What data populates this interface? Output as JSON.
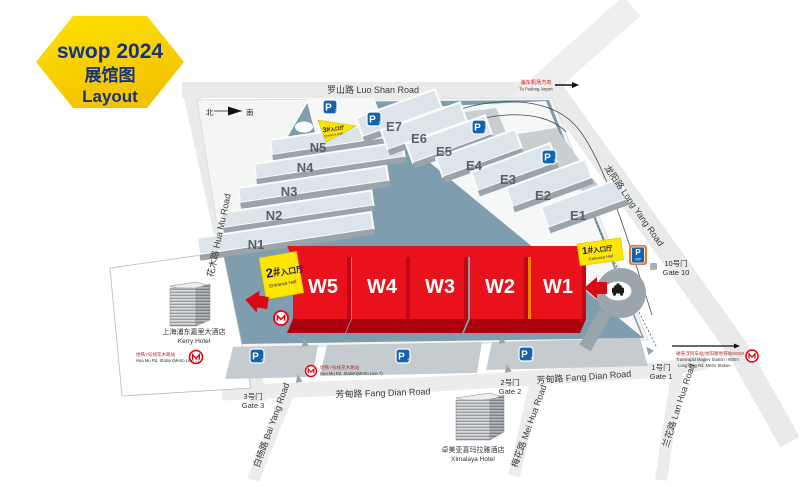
{
  "badge": {
    "title": "swop 2024",
    "subtitle_zh": "展馆图",
    "subtitle_en": "Layout"
  },
  "compass": {
    "north": "北",
    "south": "南"
  },
  "roads": {
    "luo_shan": "罗山路 Luo Shan Road",
    "long_yang": "龙阳路 Long Yang Road",
    "hua_mu": "花木路 Hua Mu Road",
    "fang_dian_west": "芳甸路 Fang Dian Road",
    "fang_dian_east": "芳甸路 Fang Dian Road",
    "bai_yang": "白杨路 Bai Yang Road",
    "mei_hua": "梅花路 Mei Hua Road",
    "lan_hua": "兰花路 Lan Hua Road"
  },
  "direction_sign": {
    "zh": "浦东机场方向",
    "en": "To Pudong Airport"
  },
  "halls": {
    "west": [
      "W5",
      "W4",
      "W3",
      "W2",
      "W1"
    ],
    "north": [
      "N5",
      "N4",
      "N3",
      "N2",
      "N1"
    ],
    "east": [
      "E7",
      "E6",
      "E5",
      "E4",
      "E3",
      "E2",
      "E1"
    ]
  },
  "entrance_halls": {
    "hall1": {
      "num": "1#",
      "zh": "入口厅",
      "en": "Entrance Hall"
    },
    "hall2": {
      "num": "2#",
      "zh": "入口厅",
      "en": "Entrance Hall"
    },
    "hall3": {
      "num": "3#",
      "zh": "入口厅",
      "en": "Entrance Hall"
    }
  },
  "gates": {
    "gate1": {
      "zh": "1号门",
      "en": "Gate 1"
    },
    "gate2": {
      "zh": "2号门",
      "en": "Gate 2"
    },
    "gate3": {
      "zh": "3号门",
      "en": "Gate 3"
    },
    "gate10": {
      "zh": "10号门",
      "en": "Gate 10"
    }
  },
  "parking_lots": [
    {
      "label": "P",
      "sub": "7"
    },
    {
      "label": "P",
      "sub": "1"
    },
    {
      "label": "P",
      "sub": "2"
    },
    {
      "label": "P",
      "sub": "3"
    },
    {
      "label": "P",
      "sub": "6"
    },
    {
      "label": "P",
      "sub": "5"
    },
    {
      "label": "P",
      "sub": "4"
    }
  ],
  "parking_vip": {
    "label": "P",
    "sub": "VIP"
  },
  "transit": {
    "huamu_station_west": {
      "zh": "地铁7号线花木路站",
      "en": "Hua Mu Rd. Station(Metro Line 7)"
    },
    "huamu_station_south": {
      "zh": "地铁7号线花木路站",
      "en": "Hua Mu Rd. Station(Metro Line 7)"
    },
    "maglev": {
      "zh": "磁悬浮列车站/龙阳路地铁站600M",
      "en1": "Transrapid Maglev Station / 600m",
      "en2": "LongYang Rd. Metro Station"
    }
  },
  "hotels": {
    "kerry": {
      "zh": "上海浦东嘉里大酒店",
      "en": "Kerry Hotel"
    },
    "ximalaya": {
      "zh": "卓美亚喜玛拉雅酒店",
      "en": "Ximalaya Hotel"
    }
  },
  "colors": {
    "hall_red": "#e8111c",
    "entrance_yellow": "#ffe600",
    "site_teal": "#7e9dae",
    "parking_blue": "#1463ae",
    "metro_red": "#e60012",
    "badge_yellow": "#ffd900",
    "badge_text": "#16337f"
  }
}
